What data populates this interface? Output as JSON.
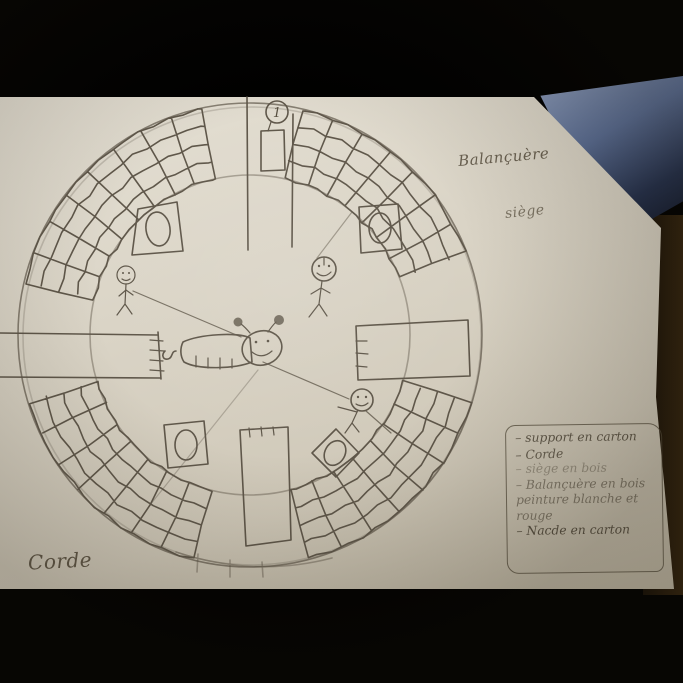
{
  "labels": {
    "structure": "Balançuère",
    "seat": "siège",
    "rope": "Corde",
    "balloon_number": "1"
  },
  "legend": {
    "items": [
      "– support en carton",
      "– Corde",
      "– siège en bois",
      "– Balançuère en bois peinture blanche et rouge",
      "– Nacde en carton"
    ]
  },
  "colors": {
    "background": "#000000",
    "paper": "#d9d2c4",
    "pencil": "#5f574a",
    "blue_object": "#5a6d94",
    "table_edge": "#25190e"
  }
}
